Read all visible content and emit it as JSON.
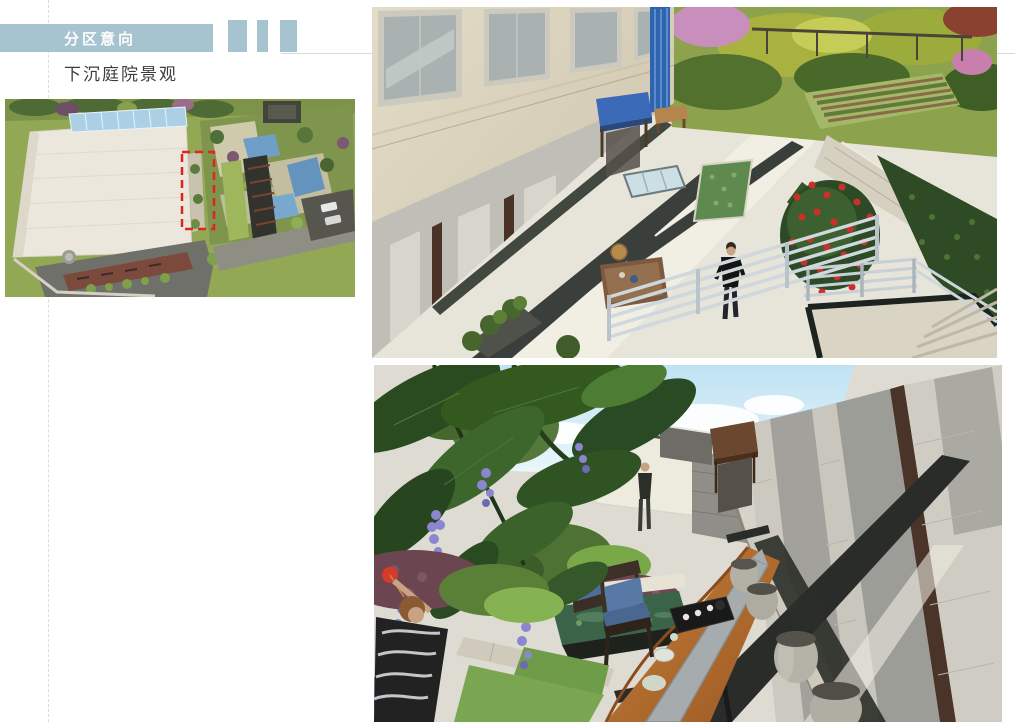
{
  "slide": {
    "background": "#ffffff"
  },
  "colors": {
    "accent_bar": "#a6c3d0",
    "header_text": "#ffffff",
    "subtitle_text": "#3d3d3d",
    "rule_line": "#d9d9d9",
    "plan_highlight_box": "#e0251c"
  },
  "header": {
    "section_label": "分区意向",
    "decor_block_count": 3
  },
  "content": {
    "subtitle": "下沉庭院景观"
  },
  "figures": {
    "site_plan": {
      "label": "aerial-site-plan-thumbnail",
      "highlight": "red-dashed-zone-marker"
    },
    "render_top": {
      "label": "sunken-courtyard-render-walkway"
    },
    "render_bottom": {
      "label": "sunken-courtyard-render-tea-table"
    }
  }
}
